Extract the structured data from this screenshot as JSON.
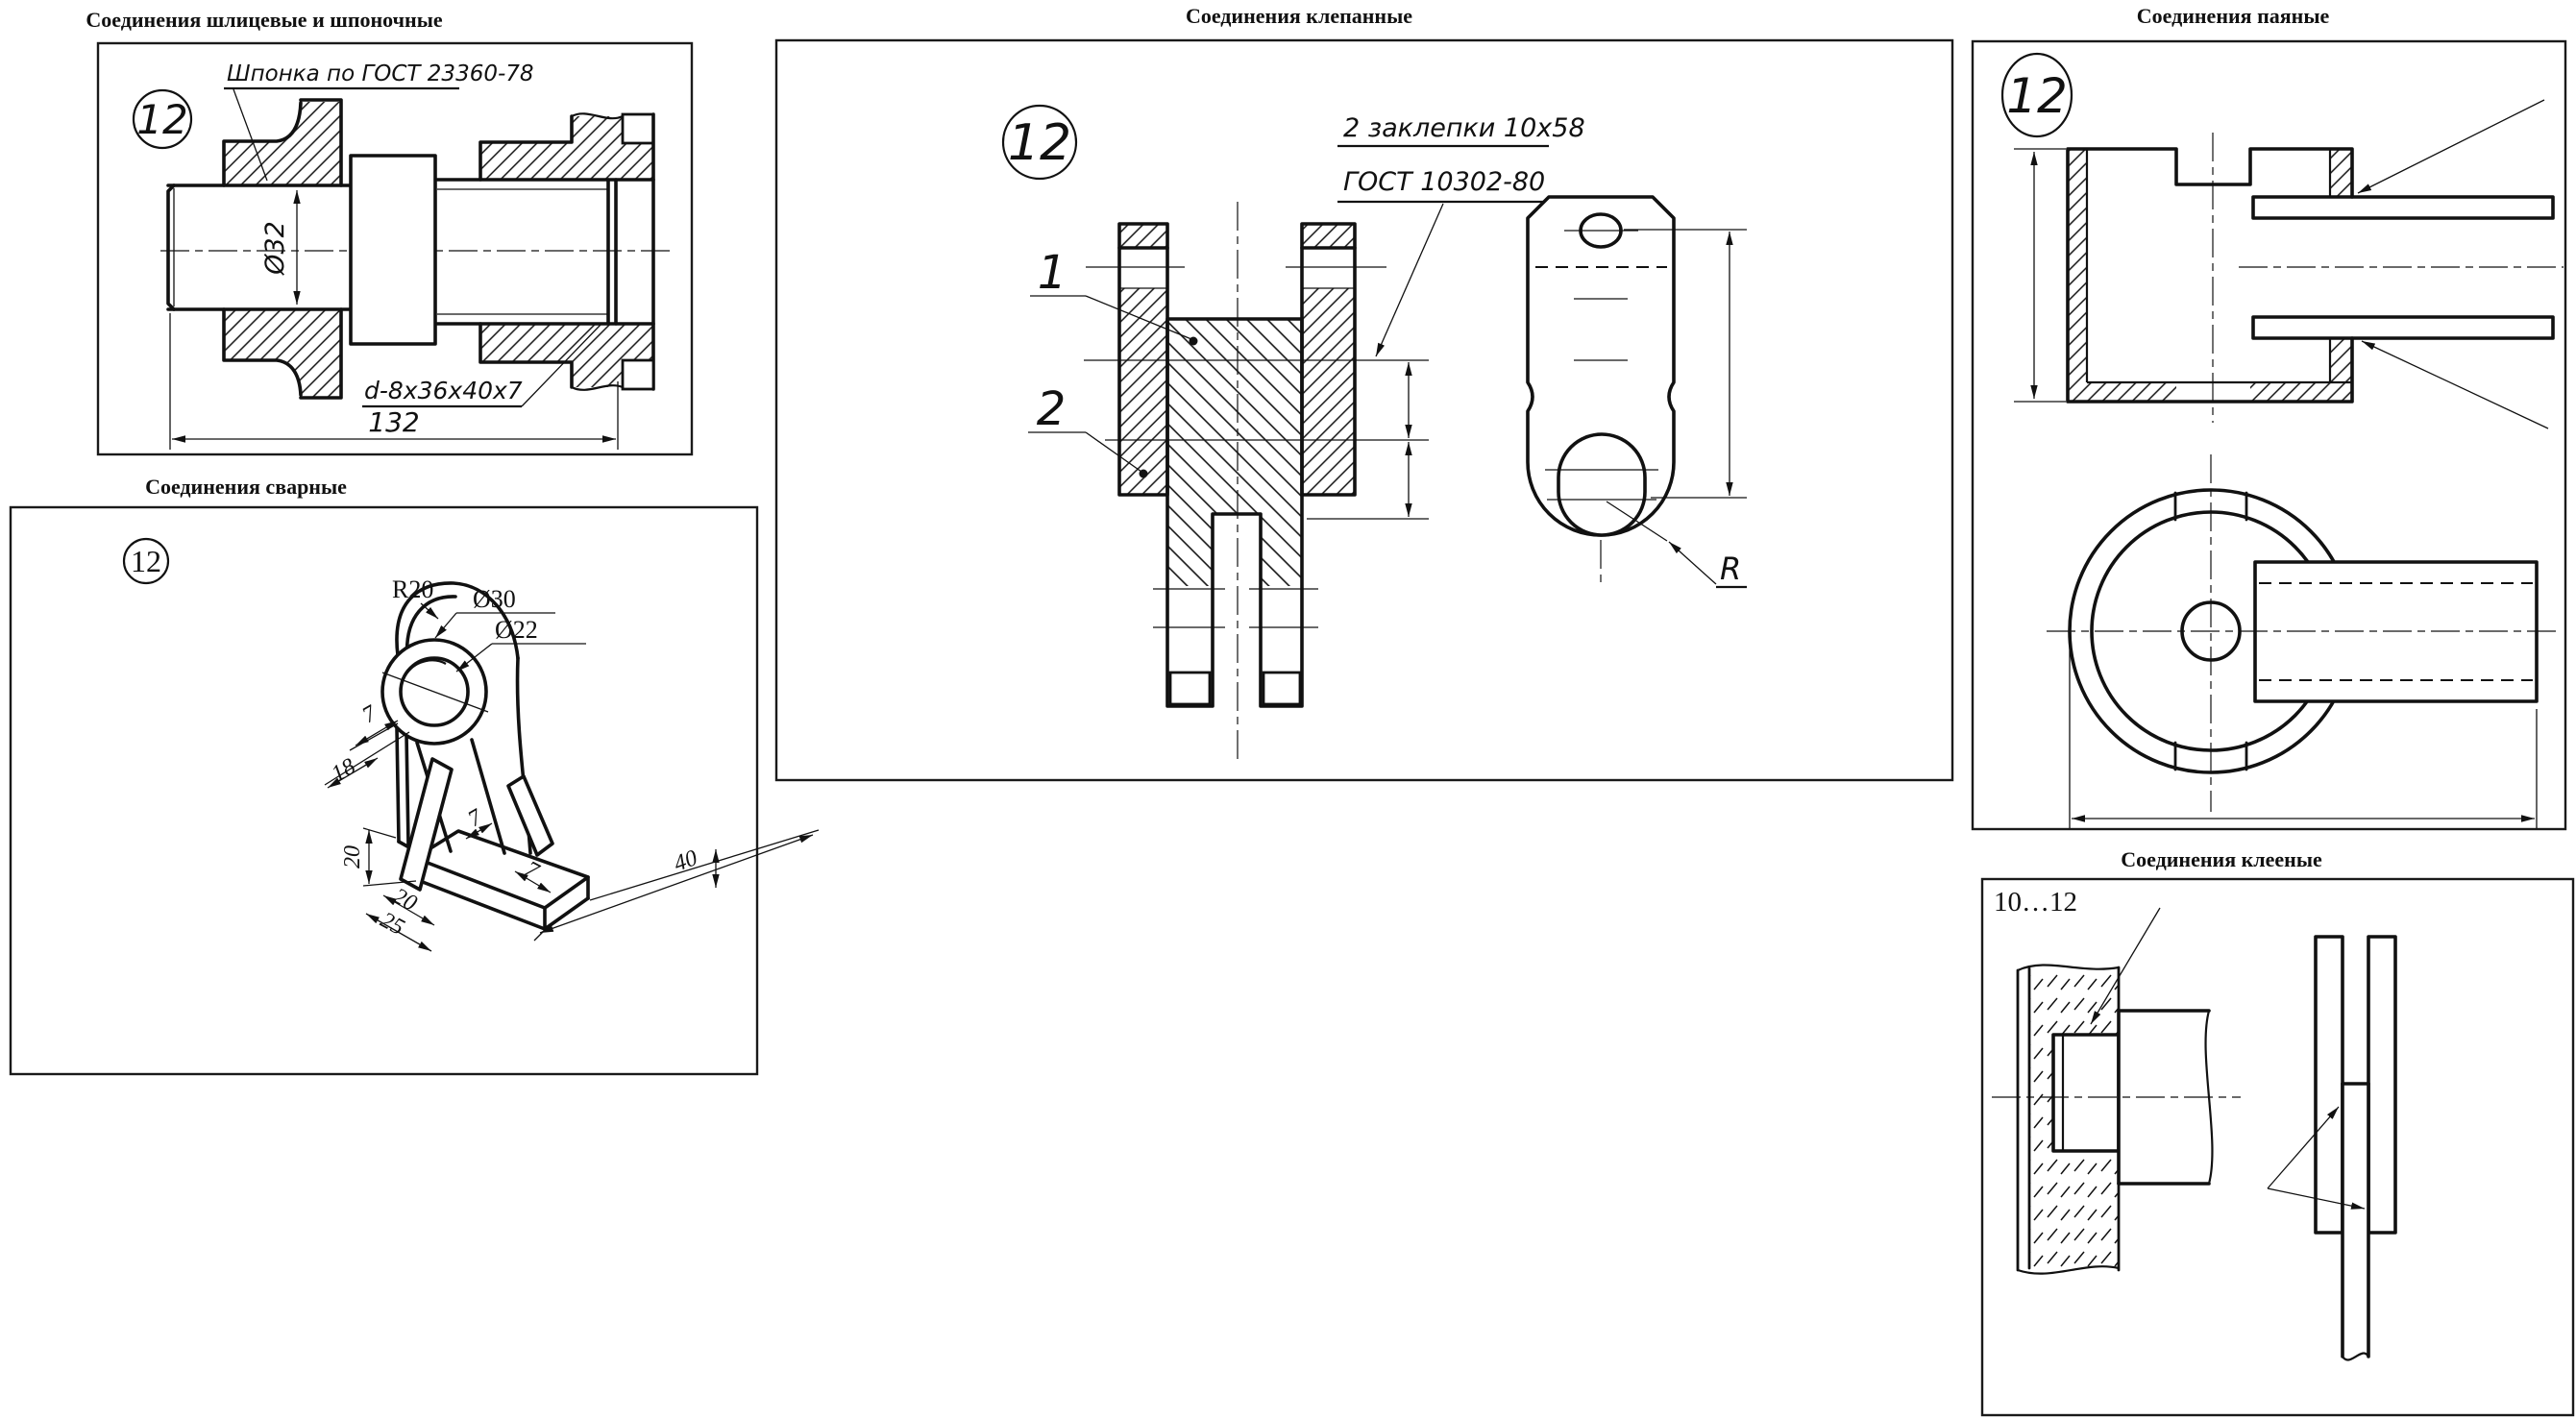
{
  "colors": {
    "ink": "#111111",
    "paper": "#ffffff"
  },
  "panels": {
    "spline": {
      "title": "Соединения шлицевые и шпоночные",
      "variant": "12",
      "key_note": "Шпонка по ГОСТ 23360-78",
      "spline_label": "d-8x36x40x7",
      "dia_label": "Ø32",
      "length_label": "132"
    },
    "welded": {
      "title": "Соединения сварные",
      "variant": "12",
      "labels": {
        "r20": "R20",
        "d30": "Ø30",
        "d22": "Ø22",
        "t7a": "7",
        "d18": "18",
        "h20": "20",
        "w20": "20",
        "w25": "25",
        "t7b": "7",
        "t7c": "7",
        "l40": "40"
      }
    },
    "riveted": {
      "title": "Соединения клепанные",
      "variant": "12",
      "note_line1": "2 заклепки 10x58",
      "note_line2": "ГОСТ 10302-80",
      "part1_label": "1",
      "part2_label": "2",
      "radius_label": "R"
    },
    "soldered": {
      "title": "Соединения паяные",
      "variant": "12"
    },
    "glued": {
      "title": "Соединения клееные",
      "variant_note": "10…12"
    }
  }
}
